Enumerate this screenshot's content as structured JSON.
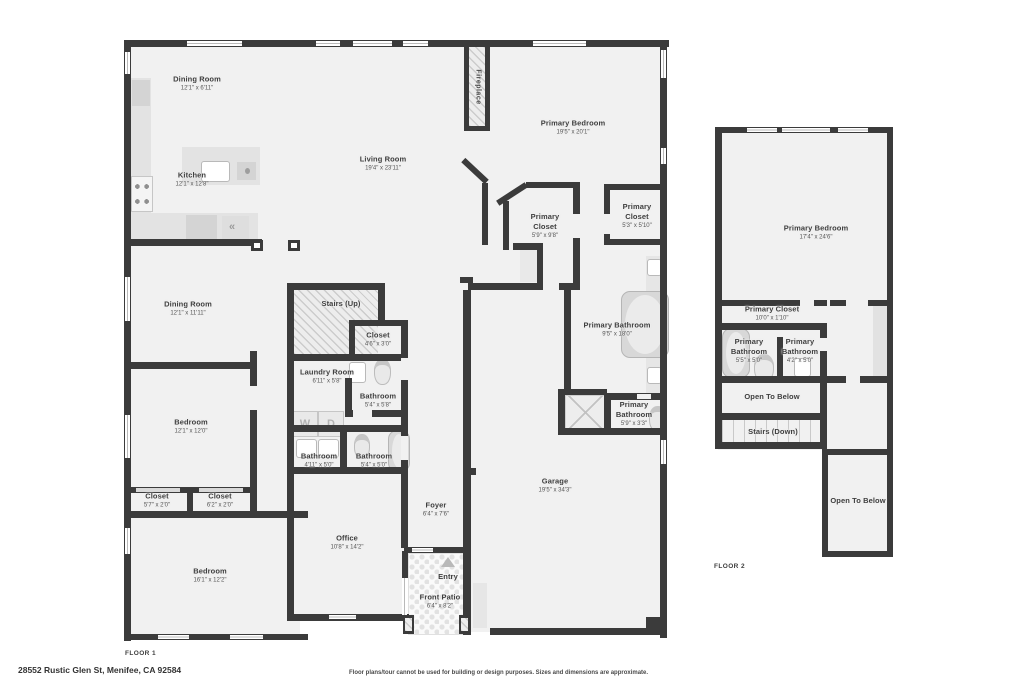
{
  "page": {
    "background": "#ffffff",
    "wall_color": "#3b3b3b",
    "floor_color": "#f1f1f1"
  },
  "floor1": {
    "label": "FLOOR 1",
    "rooms": {
      "dining1": {
        "name": "Dining Room",
        "dims": "12'1\" x 6'11\""
      },
      "kitchen": {
        "name": "Kitchen",
        "dims": "12'1\" x 12'8\""
      },
      "living": {
        "name": "Living Room",
        "dims": "19'4\" x 23'11\""
      },
      "fireplace": {
        "name": "Fireplace"
      },
      "primary_bedroom": {
        "name": "Primary Bedroom",
        "dims": "19'5\" x 20'1\""
      },
      "primary_closet_a": {
        "name": "Primary Closet",
        "dims": "5'9\" x 9'8\""
      },
      "primary_closet_b": {
        "name": "Primary Closet",
        "dims": "5'3\" x 5'10\""
      },
      "dining2": {
        "name": "Dining Room",
        "dims": "12'1\" x 11'11\""
      },
      "stairs_up": {
        "name": "Stairs (Up)"
      },
      "closet_hall": {
        "name": "Closet",
        "dims": "4'6\" x 3'0\""
      },
      "laundry": {
        "name": "Laundry Room",
        "dims": "6'11\" x 5'8\"",
        "washer": "W",
        "dryer": "D"
      },
      "bath_upper": {
        "name": "Bathroom",
        "dims": "5'4\" x 5'8\""
      },
      "primary_bath_main": {
        "name": "Primary Bathroom",
        "dims": "9'5\" x 18'0\""
      },
      "bedroom_mid": {
        "name": "Bedroom",
        "dims": "12'1\" x 12'0\""
      },
      "bath_left": {
        "name": "Bathroom",
        "dims": "4'11\" x 5'0\""
      },
      "bath_right": {
        "name": "Bathroom",
        "dims": "5'4\" x 5'0\""
      },
      "primary_bath_wc": {
        "name": "Primary Bathroom",
        "dims": "5'9\" x 3'3\""
      },
      "closet_left": {
        "name": "Closet",
        "dims": "5'7\" x 2'0\""
      },
      "closet_right": {
        "name": "Closet",
        "dims": "6'2\" x 2'0\""
      },
      "bedroom_bottom": {
        "name": "Bedroom",
        "dims": "16'1\" x 12'2\""
      },
      "office": {
        "name": "Office",
        "dims": "10'8\" x 14'2\""
      },
      "foyer": {
        "name": "Foyer",
        "dims": "6'4\" x 7'6\""
      },
      "garage": {
        "name": "Garage",
        "dims": "19'5\" x 34'3\""
      },
      "entry": {
        "name": "Entry"
      },
      "front_patio": {
        "name": "Front Patio",
        "dims": "6'4\" x 8'2\""
      }
    },
    "icons": {
      "vent": "«"
    }
  },
  "floor2": {
    "label": "FLOOR 2",
    "rooms": {
      "primary_bedroom": {
        "name": "Primary Bedroom",
        "dims": "17'4\" x 24'6\""
      },
      "primary_closet": {
        "name": "Primary Closet",
        "dims": "10'0\" x 1'10\""
      },
      "primary_bath_a": {
        "name": "Primary Bathroom",
        "dims": "5'5\" x 5'0\""
      },
      "primary_bath_b": {
        "name": "Primary Bathroom",
        "dims": "4'2\" x 5'0\""
      },
      "open_below_a": {
        "name": "Open To Below"
      },
      "stairs_down": {
        "name": "Stairs (Down)"
      },
      "open_below_b": {
        "name": "Open To Below"
      }
    }
  },
  "footer": {
    "address": "28552 Rustic Glen St, Menifee, CA 92584",
    "disclaimer": "Floor plans/tour cannot be used for building or design purposes. Sizes and dimensions are approximate."
  }
}
